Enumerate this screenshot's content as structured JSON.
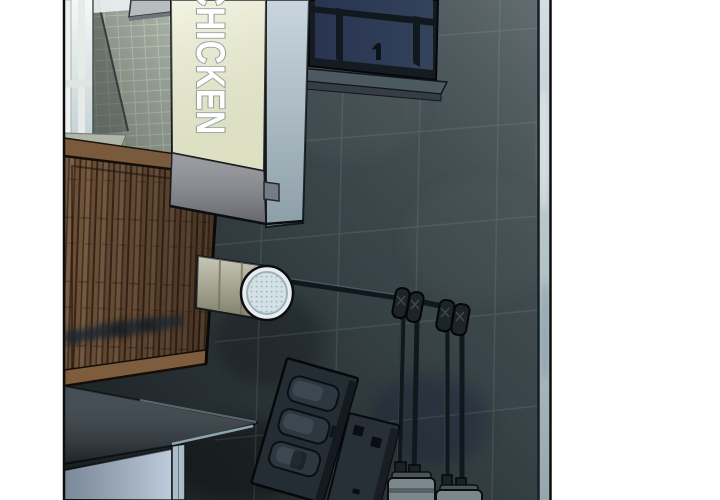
{
  "scene": {
    "sign_text": "CHICKEN",
    "colors": {
      "wall": "#3e4b50",
      "tile_wall": "#a6afa3",
      "bright_window": "#e9f0f2",
      "sign_face": "#edf0d6",
      "sign_side": "#b5c7d1",
      "sign_band": "#8b8c94",
      "wood_base": "#6b4e36",
      "awning": "#2c363e",
      "window_glow": "#a3b6cc",
      "edge_strip": "#c3d3da",
      "duct_tube": "#b3b298",
      "duct_cap": "#d3e0e5",
      "pipe": "#11181d",
      "meter_body": "#7b868d"
    }
  }
}
